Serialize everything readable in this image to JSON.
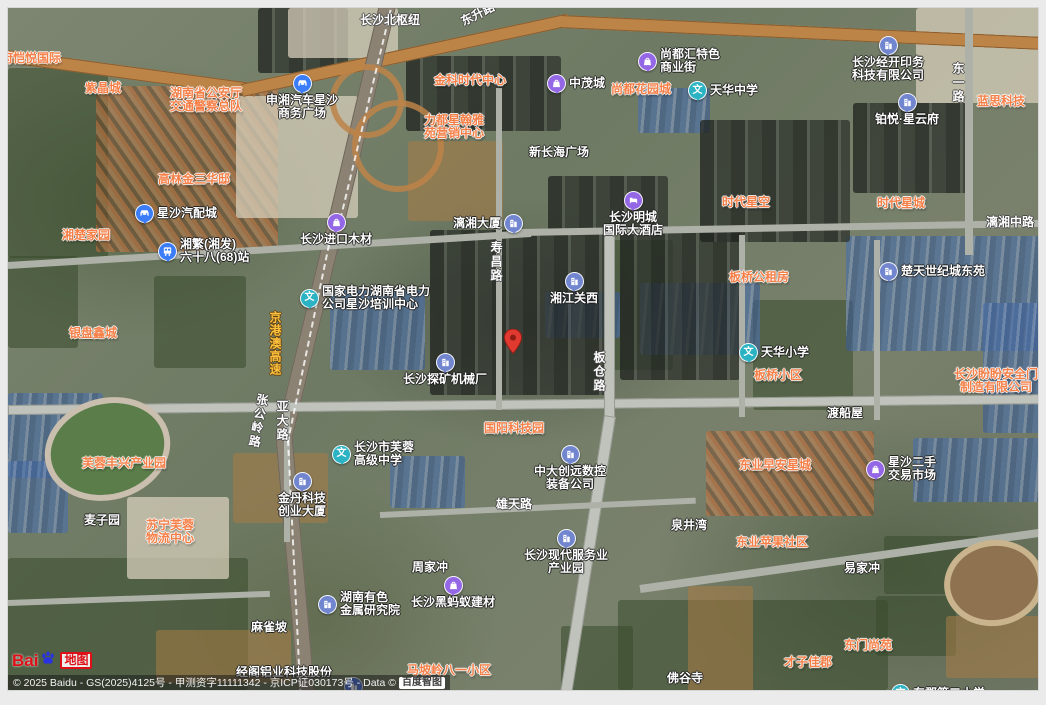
{
  "logo": {
    "bai": "Bai",
    "word": "地图"
  },
  "copyright": {
    "line": "© 2025 Baidu - GS(2025)4125号 - 甲测资字11111342 - 京ICP证030173号 - Data © ",
    "chip": "百度智图"
  },
  "pin": {
    "x": 496,
    "y": 321
  },
  "clipped_pin": {
    "x": 336,
    "y": 669
  },
  "icon_colors": {
    "transport": "#3b7cf8",
    "school": "#2bb3c4",
    "shop": "#9467e6",
    "company": "#7186cf",
    "hotel": "#9467e6"
  },
  "label_colors": {
    "estate": "#f57f47",
    "poi": "#ffffff",
    "road": "#ffffff",
    "highway": "#ffc23d"
  },
  "school_glyph": "文",
  "pois": [
    {
      "lines": [
        "湘府恺悦国际"
      ],
      "x": -19,
      "y": 44,
      "style": "orange"
    },
    {
      "lines": [
        "紫晶城"
      ],
      "x": 77,
      "y": 74,
      "style": "orange"
    },
    {
      "lines": [
        "湖南省公安厅",
        "交通警察总队"
      ],
      "x": 162,
      "y": 79,
      "style": "orange"
    },
    {
      "lines": [
        "高林金三华邸"
      ],
      "x": 150,
      "y": 165,
      "style": "orange"
    },
    {
      "lines": [
        "湘楚家园"
      ],
      "x": 54,
      "y": 221,
      "style": "orange"
    },
    {
      "lines": [
        "银盘鑫城"
      ],
      "x": 61,
      "y": 319,
      "style": "orange"
    },
    {
      "lines": [
        "金科时代中心"
      ],
      "x": 426,
      "y": 66,
      "style": "orange"
    },
    {
      "lines": [
        "力都星翰雅",
        "苑营销中心"
      ],
      "x": 416,
      "y": 106,
      "style": "orange"
    },
    {
      "lines": [
        "尚都花园城"
      ],
      "x": 603,
      "y": 75,
      "style": "orange"
    },
    {
      "lines": [
        "时代星空"
      ],
      "x": 714,
      "y": 188,
      "style": "orange"
    },
    {
      "lines": [
        "时代星城"
      ],
      "x": 869,
      "y": 189,
      "style": "orange"
    },
    {
      "lines": [
        "蓝思科技"
      ],
      "x": 969,
      "y": 87,
      "style": "orange"
    },
    {
      "lines": [
        "板桥公租房"
      ],
      "x": 721,
      "y": 263,
      "style": "orange"
    },
    {
      "lines": [
        "板桥小区"
      ],
      "x": 746,
      "y": 361,
      "style": "orange"
    },
    {
      "lines": [
        "长沙盼盼安全门",
        "制造有限公司"
      ],
      "x": 946,
      "y": 360,
      "style": "orange"
    },
    {
      "lines": [
        "国阳科技园"
      ],
      "x": 476,
      "y": 414,
      "style": "orange"
    },
    {
      "lines": [
        "芙蓉丰兴产业园"
      ],
      "x": 74,
      "y": 449,
      "style": "orange"
    },
    {
      "lines": [
        "苏宁芙蓉",
        "物流中心"
      ],
      "x": 138,
      "y": 511,
      "style": "orange"
    },
    {
      "lines": [
        "东业早安星城"
      ],
      "x": 731,
      "y": 451,
      "style": "orange"
    },
    {
      "lines": [
        "东业苹果社区"
      ],
      "x": 728,
      "y": 528,
      "style": "orange"
    },
    {
      "lines": [
        "东门尚苑"
      ],
      "x": 836,
      "y": 631,
      "style": "orange"
    },
    {
      "lines": [
        "才子佳郡"
      ],
      "x": 776,
      "y": 648,
      "style": "orange"
    },
    {
      "lines": [
        "马坡岭八一小区"
      ],
      "x": 399,
      "y": 656,
      "style": "orange"
    },
    {
      "lines": [
        "新长海广场"
      ],
      "x": 521,
      "y": 138,
      "style": "white"
    },
    {
      "lines": [
        "渡船屋"
      ],
      "x": 819,
      "y": 399,
      "style": "white"
    },
    {
      "lines": [
        "泉井湾"
      ],
      "x": 663,
      "y": 511,
      "style": "white"
    },
    {
      "lines": [
        "易家冲"
      ],
      "x": 836,
      "y": 554,
      "style": "white"
    },
    {
      "lines": [
        "佛谷寺"
      ],
      "x": 659,
      "y": 664,
      "style": "white"
    },
    {
      "lines": [
        "麻雀坡"
      ],
      "x": 243,
      "y": 613,
      "style": "white"
    },
    {
      "lines": [
        "周家冲"
      ],
      "x": 404,
      "y": 553,
      "style": "white"
    },
    {
      "lines": [
        "麦子园"
      ],
      "x": 76,
      "y": 506,
      "style": "white"
    },
    {
      "lines": [
        "经阁铝业科技股份"
      ],
      "x": 228,
      "y": 658,
      "style": "white"
    },
    {
      "lines": [
        "有限公司"
      ],
      "x": 278,
      "y": 683,
      "style": "white"
    },
    {
      "lines": [
        "申湘汽车星沙",
        "商务广场"
      ],
      "x": 258,
      "y": 66,
      "style": "white",
      "icon": "car",
      "pos": "top"
    },
    {
      "lines": [
        "星沙汽配城"
      ],
      "x": 127,
      "y": 196,
      "style": "white",
      "icon": "car",
      "pos": "left"
    },
    {
      "lines": [
        "湘繁(湘发)",
        "六十八(68)站"
      ],
      "x": 150,
      "y": 230,
      "style": "white",
      "icon": "bus",
      "pos": "left",
      "align": "left"
    },
    {
      "lines": [
        "中茂城"
      ],
      "x": 539,
      "y": 66,
      "style": "white",
      "icon": "shop",
      "pos": "left"
    },
    {
      "lines": [
        "尚都汇特色",
        "商业街"
      ],
      "x": 630,
      "y": 40,
      "style": "white",
      "icon": "shop",
      "pos": "left",
      "align": "left"
    },
    {
      "lines": [
        "天华中学"
      ],
      "x": 680,
      "y": 73,
      "style": "white",
      "icon": "school",
      "pos": "left"
    },
    {
      "lines": [
        "长沙经开印务",
        "科技有限公司"
      ],
      "x": 844,
      "y": 28,
      "style": "white",
      "icon": "company",
      "pos": "top"
    },
    {
      "lines": [
        "铂悦·星云府"
      ],
      "x": 867,
      "y": 85,
      "style": "white",
      "icon": "company",
      "pos": "top"
    },
    {
      "lines": [
        "长沙进口木材"
      ],
      "x": 292,
      "y": 205,
      "style": "white",
      "icon": "shop",
      "pos": "top"
    },
    {
      "lines": [
        "国家电力湖南省电力",
        "公司星沙培训中心"
      ],
      "x": 292,
      "y": 277,
      "style": "white",
      "icon": "school",
      "pos": "left",
      "align": "left"
    },
    {
      "lines": [
        "湘江关西"
      ],
      "x": 542,
      "y": 264,
      "style": "white",
      "icon": "company",
      "pos": "top"
    },
    {
      "lines": [
        "漓湘大厦"
      ],
      "x": 445,
      "y": 206,
      "style": "white",
      "icon": "company",
      "pos": "right"
    },
    {
      "lines": [
        "长沙明城",
        "国际大酒店"
      ],
      "x": 595,
      "y": 183,
      "style": "white",
      "icon": "hotel",
      "pos": "top"
    },
    {
      "lines": [
        "楚天世纪城东苑"
      ],
      "x": 871,
      "y": 254,
      "style": "white",
      "icon": "company",
      "pos": "left"
    },
    {
      "lines": [
        "天华小学"
      ],
      "x": 731,
      "y": 335,
      "style": "white",
      "icon": "school",
      "pos": "left"
    },
    {
      "lines": [
        "长沙探矿机械厂"
      ],
      "x": 395,
      "y": 345,
      "style": "white",
      "icon": "company",
      "pos": "top"
    },
    {
      "lines": [
        "金丹科技",
        "创业大厦"
      ],
      "x": 270,
      "y": 464,
      "style": "white",
      "icon": "company",
      "pos": "top"
    },
    {
      "lines": [
        "湖南有色",
        "金属研究院"
      ],
      "x": 310,
      "y": 583,
      "style": "white",
      "icon": "company",
      "pos": "left",
      "align": "left"
    },
    {
      "lines": [
        "长沙市芙蓉",
        "高级中学"
      ],
      "x": 324,
      "y": 433,
      "style": "white",
      "icon": "school",
      "pos": "left",
      "align": "left"
    },
    {
      "lines": [
        "中大创远数控",
        "装备公司"
      ],
      "x": 526,
      "y": 437,
      "style": "white",
      "icon": "company",
      "pos": "top"
    },
    {
      "lines": [
        "长沙现代服务业",
        "产业园"
      ],
      "x": 516,
      "y": 521,
      "style": "white",
      "icon": "company",
      "pos": "top"
    },
    {
      "lines": [
        "长沙黑蚂蚁建材"
      ],
      "x": 403,
      "y": 568,
      "style": "white",
      "icon": "shop",
      "pos": "top"
    },
    {
      "lines": [
        "星沙二手",
        "交易市场"
      ],
      "x": 858,
      "y": 448,
      "style": "white",
      "icon": "shop",
      "pos": "left",
      "align": "left"
    },
    {
      "lines": [
        "东郡第二小学"
      ],
      "x": 883,
      "y": 676,
      "style": "white",
      "icon": "school",
      "pos": "left"
    },
    {
      "lines": [
        "长沙北枢纽"
      ],
      "x": 352,
      "y": 6,
      "style": "road"
    },
    {
      "lines": [
        "东升路"
      ],
      "x": 452,
      "y": 0,
      "style": "road",
      "rot": -27
    },
    {
      "lines": [
        "东一路"
      ],
      "x": 943,
      "y": 54,
      "style": "road",
      "vert": true
    },
    {
      "lines": [
        "漓湘中路"
      ],
      "x": 978,
      "y": 208,
      "style": "road"
    },
    {
      "lines": [
        "寿昌路"
      ],
      "x": 481,
      "y": 233,
      "style": "road",
      "vert": true
    },
    {
      "lines": [
        "板仓路"
      ],
      "x": 584,
      "y": 343,
      "style": "road",
      "vert": true
    },
    {
      "lines": [
        "京港澳高速"
      ],
      "x": 260,
      "y": 303,
      "style": "gold",
      "vert": true
    },
    {
      "lines": [
        "张公岭路"
      ],
      "x": 243,
      "y": 385,
      "style": "road",
      "vert": true,
      "rot": 10
    },
    {
      "lines": [
        "亚大路"
      ],
      "x": 267,
      "y": 392,
      "style": "road",
      "vert": true
    },
    {
      "lines": [
        "雄天路"
      ],
      "x": 488,
      "y": 490,
      "style": "road"
    }
  ]
}
